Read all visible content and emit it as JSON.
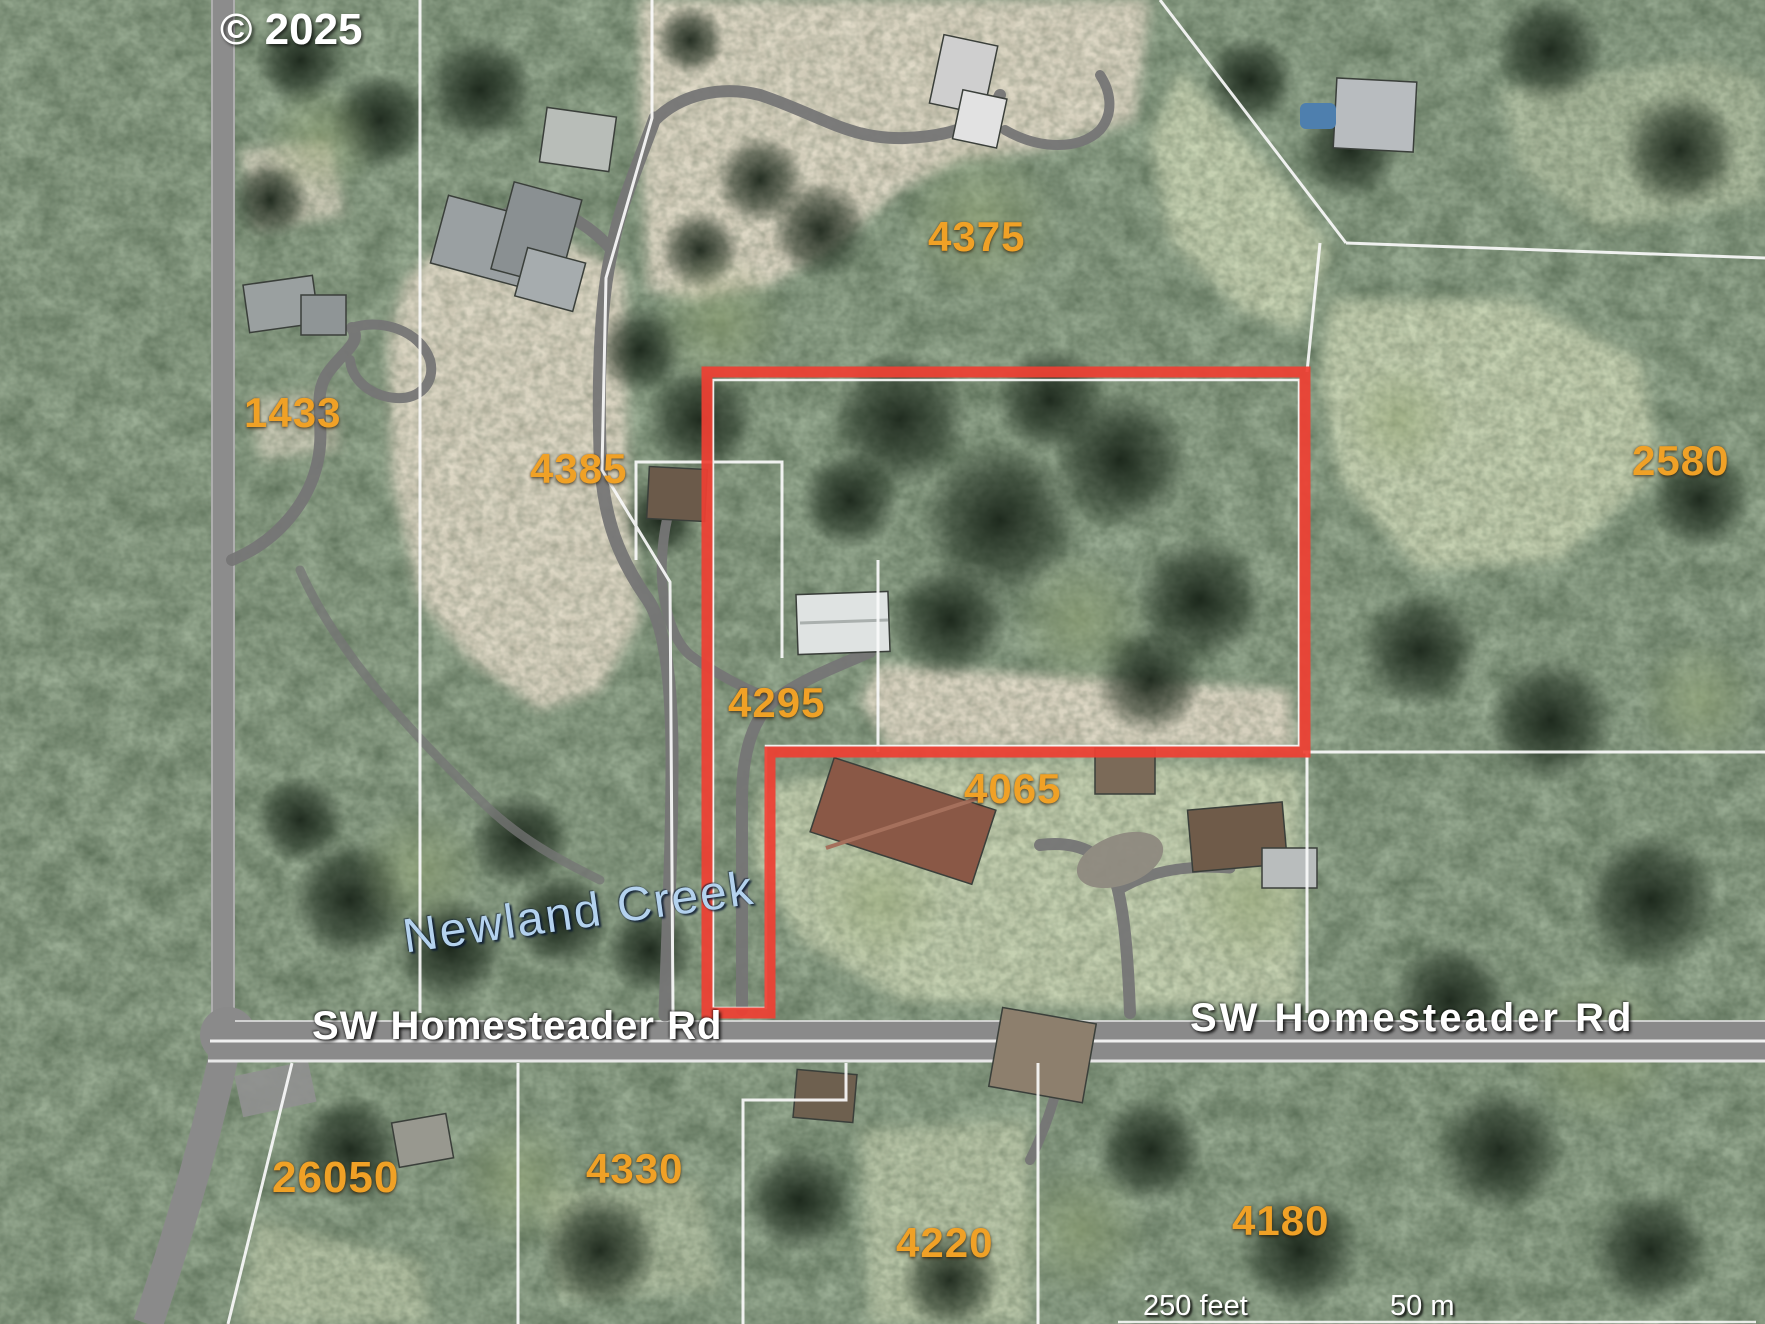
{
  "attribution": "© 2025",
  "map": {
    "parcel_labels": [
      {
        "text": "4375"
      },
      {
        "text": "4385"
      },
      {
        "text": "1433"
      },
      {
        "text": "2580"
      },
      {
        "text": "4295"
      },
      {
        "text": "4065"
      },
      {
        "text": "26050"
      },
      {
        "text": "4330"
      },
      {
        "text": "4220"
      },
      {
        "text": "4180"
      }
    ],
    "road_labels": [
      {
        "text": "SW Homesteader Rd"
      },
      {
        "text": "SW Homesteader Rd"
      }
    ],
    "water_label": {
      "text": "Newland Creek"
    },
    "scale": {
      "feet": "250 feet",
      "meters": "50 m"
    },
    "colors": {
      "highlight_outline": "#ee4033",
      "parcel_label": "#f0a126",
      "water_label": "#b4d2ee",
      "road_label": "#ffffff",
      "boundary_line": "#fafafa"
    }
  }
}
